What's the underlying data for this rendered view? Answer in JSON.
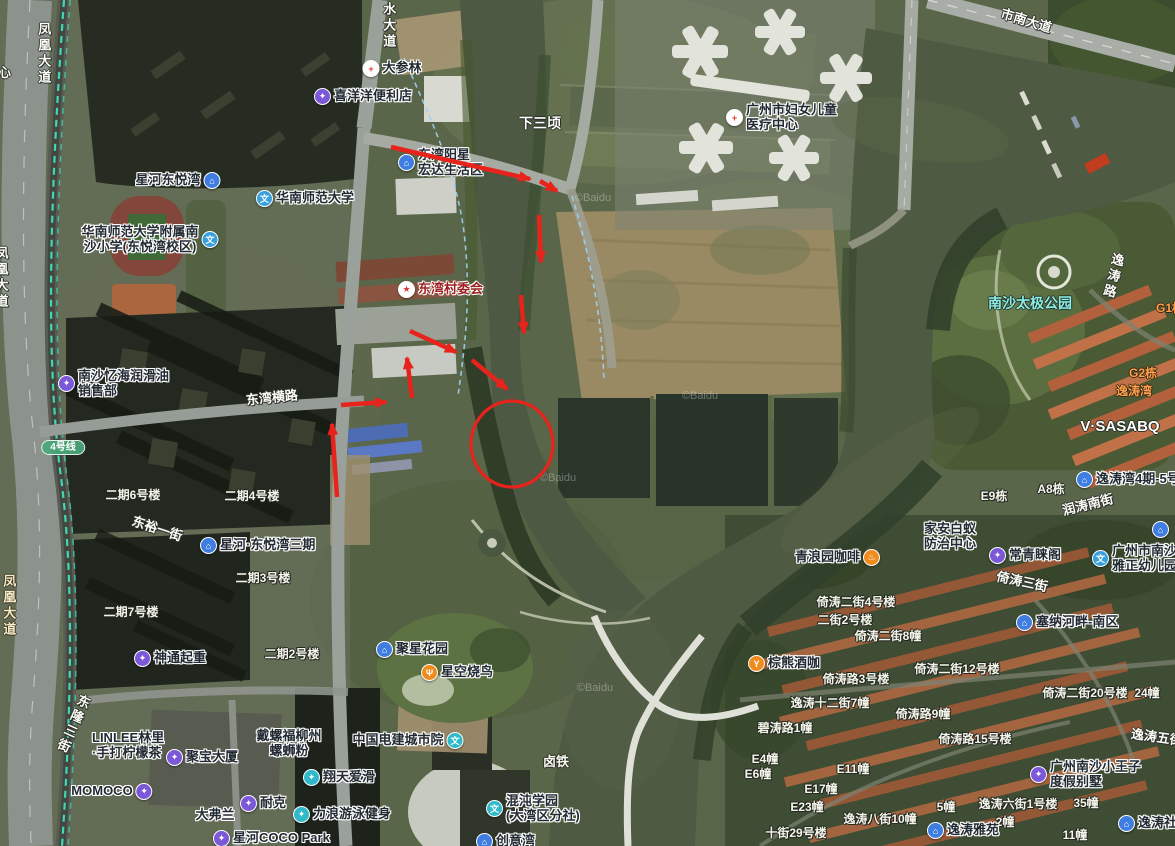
{
  "map": {
    "attribution": "©Baidu",
    "annotation_color": "#e8231c",
    "water_color": "#4f5a42",
    "metro_line_color": "#3fe0bc",
    "icons": {
      "building": {
        "glyph": "⌂",
        "bg": "#3f7de0"
      },
      "shop": {
        "glyph": "✦",
        "bg": "#7a58d8"
      },
      "school": {
        "glyph": "文",
        "bg": "#38a0dc"
      },
      "school_teal": {
        "glyph": "文",
        "bg": "#2fb9c9"
      },
      "hospital": {
        "glyph": "+",
        "bg": "#ffffff",
        "fg": "#e23b30"
      },
      "gov": {
        "glyph": "★",
        "bg": "#ffffff",
        "fg": "#d8383a"
      },
      "pharmacy": {
        "glyph": "+",
        "bg": "#ffffff",
        "fg": "#e23b30"
      },
      "coffee": {
        "glyph": "♨",
        "bg": "#f08c1e"
      },
      "bar": {
        "glyph": "Y",
        "bg": "#f08c1e"
      },
      "food": {
        "glyph": "Ψ",
        "bg": "#f08c1e"
      },
      "sport": {
        "glyph": "✦",
        "bg": "#2fb9c9"
      }
    },
    "labels": [
      {
        "text": "凤凰大道",
        "x": 43,
        "y": 22,
        "type": "road",
        "vertical": true
      },
      {
        "text": "心",
        "x": -2,
        "y": 66,
        "type": "area",
        "anchor": "left"
      },
      {
        "text": "凤凰大道",
        "x": -7,
        "y": 246,
        "type": "road",
        "vertical": true,
        "anchor": "left"
      },
      {
        "text": "凤凰大道",
        "x": 8,
        "y": 574,
        "type": "road_y",
        "vertical": true
      },
      {
        "text": "滨水大道",
        "x": 388,
        "y": -14,
        "type": "road",
        "vertical": true
      },
      {
        "text": "大参林",
        "x": 392,
        "y": 60,
        "type": "poi",
        "icon": "pharmacy"
      },
      {
        "text": "喜洋洋便利店",
        "x": 363,
        "y": 88,
        "type": "poi",
        "icon": "shop"
      },
      {
        "text": "下三顷",
        "x": 540,
        "y": 116,
        "type": "area_lg"
      },
      {
        "text": "市南大道",
        "x": 1026,
        "y": 14,
        "type": "road",
        "rot": 17
      },
      {
        "lines": [
          "广州市妇女儿童",
          "医疗中心"
        ],
        "x": 726,
        "y": 103,
        "type": "poi",
        "icon": "hospital",
        "anchor": "left",
        "align": "left"
      },
      {
        "text": "星河东悦湾",
        "x": 178,
        "y": 172,
        "type": "poi",
        "icon": "building",
        "icon_side": "right"
      },
      {
        "text": "华南师范大学",
        "x": 305,
        "y": 190,
        "type": "poi",
        "icon": "school"
      },
      {
        "lines": [
          "华南师范大学附属南",
          "沙小学(东悦湾校区)"
        ],
        "x": 150,
        "y": 225,
        "type": "poi",
        "icon": "school",
        "icon_side": "right"
      },
      {
        "lines": [
          "东湾阳星",
          "宏达生活区"
        ],
        "x": 398,
        "y": 148,
        "type": "poi",
        "icon": "building",
        "anchor": "left",
        "align": "left"
      },
      {
        "text": "东湾村委会",
        "x": 398,
        "y": 281,
        "type": "gov",
        "icon": "gov",
        "anchor": "left"
      },
      {
        "lines": [
          "南沙忆海润滑油",
          "销售部"
        ],
        "x": 58,
        "y": 369,
        "type": "poi",
        "icon": "shop",
        "anchor": "left",
        "align": "left"
      },
      {
        "text": "东湾横路",
        "x": 272,
        "y": 391,
        "type": "road",
        "rot": -6
      },
      {
        "text": "4号线",
        "x": 63,
        "y": 440,
        "type": "metro"
      },
      {
        "text": "二期6号楼",
        "x": 133,
        "y": 489,
        "type": "bldg"
      },
      {
        "text": "二期4号楼",
        "x": 252,
        "y": 490,
        "type": "bldg"
      },
      {
        "text": "东裕一街",
        "x": 157,
        "y": 522,
        "type": "road",
        "rot": 18
      },
      {
        "text": "星河·东悦湾三期",
        "x": 200,
        "y": 537,
        "type": "poi",
        "icon": "building",
        "anchor": "left"
      },
      {
        "text": "二期3号楼",
        "x": 263,
        "y": 572,
        "type": "bldg"
      },
      {
        "text": "二期7号楼",
        "x": 131,
        "y": 606,
        "type": "bldg"
      },
      {
        "text": "神通起重",
        "x": 134,
        "y": 650,
        "type": "poi",
        "icon": "shop",
        "anchor": "left"
      },
      {
        "text": "二期2号楼",
        "x": 292,
        "y": 648,
        "type": "bldg"
      },
      {
        "text": "东隆三街",
        "x": 72,
        "y": 692,
        "type": "road",
        "vertical": true,
        "rot": 24
      },
      {
        "lines": [
          "LINLEE林里",
          "·手打柠檬茶"
        ],
        "x": 92,
        "y": 731,
        "type": "poi_plain",
        "anchor": "left",
        "align": "left"
      },
      {
        "text": "聚宝大厦",
        "x": 166,
        "y": 749,
        "type": "poi",
        "icon": "shop",
        "anchor": "left"
      },
      {
        "text": "MOMOCO",
        "x": 112,
        "y": 783,
        "type": "poi",
        "icon": "shop",
        "icon_side": "right"
      },
      {
        "lines": [
          "戴螺福柳州",
          "螺蛳粉"
        ],
        "x": 289,
        "y": 729,
        "type": "poi_plain"
      },
      {
        "text": "翔天爱滑",
        "x": 303,
        "y": 769,
        "type": "poi",
        "icon": "sport",
        "anchor": "left"
      },
      {
        "text": "耐克",
        "x": 240,
        "y": 795,
        "type": "poi",
        "icon": "shop",
        "anchor": "left"
      },
      {
        "text": "大弗兰",
        "x": 215,
        "y": 808,
        "type": "poi_plain"
      },
      {
        "text": "力浪游泳健身",
        "x": 293,
        "y": 806,
        "type": "poi",
        "icon": "sport",
        "anchor": "left"
      },
      {
        "text": "星河COCO Park",
        "x": 213,
        "y": 830,
        "type": "poi",
        "icon": "shop",
        "anchor": "left"
      },
      {
        "text": "聚星花园",
        "x": 376,
        "y": 641,
        "type": "poi",
        "icon": "building",
        "anchor": "left"
      },
      {
        "text": "星空烧鸟",
        "x": 421,
        "y": 664,
        "type": "poi",
        "icon": "food",
        "anchor": "left"
      },
      {
        "text": "中国电建城市院",
        "x": 408,
        "y": 732,
        "type": "poi",
        "icon": "school_teal",
        "icon_side": "right"
      },
      {
        "text": "卤铁",
        "x": 556,
        "y": 755,
        "type": "area"
      },
      {
        "lines": [
          "混沌学园",
          "(大湾区分社)"
        ],
        "x": 486,
        "y": 794,
        "type": "poi",
        "icon": "school_teal",
        "anchor": "left",
        "align": "left"
      },
      {
        "text": "创意湾",
        "x": 476,
        "y": 833,
        "type": "poi",
        "icon": "building",
        "anchor": "left"
      },
      {
        "text": "南沙太极公园",
        "x": 1030,
        "y": 296,
        "type": "cyan"
      },
      {
        "text": "逸涛路",
        "x": 1112,
        "y": 252,
        "type": "road",
        "vertical": true,
        "rot": 14
      },
      {
        "text": "G1栋",
        "x": 1156,
        "y": 302,
        "type": "orange",
        "anchor": "left"
      },
      {
        "text": "G2栋",
        "x": 1143,
        "y": 367,
        "type": "orange"
      },
      {
        "text": "逸涛湾",
        "x": 1134,
        "y": 385,
        "type": "orange"
      },
      {
        "text": "V·SASABQ",
        "x": 1120,
        "y": 419,
        "type": "white_lg"
      },
      {
        "text": "E9栋",
        "x": 994,
        "y": 490,
        "type": "bldg"
      },
      {
        "text": "A8栋",
        "x": 1051,
        "y": 483,
        "type": "bldg"
      },
      {
        "text": "逸涛湾4期-5号门",
        "x": 1076,
        "y": 471,
        "type": "poi",
        "icon": "building",
        "anchor": "left"
      },
      {
        "text": "润涛南街",
        "x": 1088,
        "y": 498,
        "type": "road",
        "rot": -14
      },
      {
        "lines": [
          "家安白蚁",
          "防治中心"
        ],
        "x": 950,
        "y": 522,
        "type": "poi_plain"
      },
      {
        "text": "常青睐阁",
        "x": 989,
        "y": 547,
        "type": "poi",
        "icon": "shop",
        "anchor": "left"
      },
      {
        "lines": [
          "广州市南沙",
          "雅正幼儿园"
        ],
        "x": 1092,
        "y": 544,
        "type": "poi",
        "icon": "school",
        "anchor": "left",
        "align": "left"
      },
      {
        "text": "",
        "x": 1152,
        "y": 521,
        "type": "poi",
        "icon": "building",
        "anchor": "left"
      },
      {
        "text": "青浪园咖啡",
        "x": 795,
        "y": 549,
        "type": "poi",
        "icon": "coffee",
        "icon_side": "right",
        "anchor": "left"
      },
      {
        "text": "倚涛三街",
        "x": 1022,
        "y": 575,
        "type": "road",
        "rot": 12
      },
      {
        "text": "倚涛二街4号楼",
        "x": 856,
        "y": 596,
        "type": "bldg"
      },
      {
        "text": "二街2号楼",
        "x": 845,
        "y": 614,
        "type": "bldg"
      },
      {
        "text": "倚涛二街8幢",
        "x": 888,
        "y": 630,
        "type": "bldg"
      },
      {
        "text": "塞纳河畔-南区",
        "x": 1016,
        "y": 614,
        "type": "poi",
        "icon": "building",
        "anchor": "left"
      },
      {
        "text": "棕熊酒咖",
        "x": 748,
        "y": 655,
        "type": "poi",
        "icon": "bar",
        "anchor": "left"
      },
      {
        "text": "倚涛二街12号楼",
        "x": 957,
        "y": 663,
        "type": "bldg"
      },
      {
        "text": "倚涛路3号楼",
        "x": 856,
        "y": 673,
        "type": "bldg"
      },
      {
        "text": "逸涛十二街7幢",
        "x": 830,
        "y": 697,
        "type": "bldg"
      },
      {
        "text": "倚涛路9幢",
        "x": 923,
        "y": 708,
        "type": "bldg"
      },
      {
        "text": "碧涛路1幢",
        "x": 785,
        "y": 722,
        "type": "bldg"
      },
      {
        "text": "倚涛路15号楼",
        "x": 975,
        "y": 733,
        "type": "bldg"
      },
      {
        "text": "倚涛二街20号楼  24幢",
        "x": 1101,
        "y": 687,
        "type": "bldg"
      },
      {
        "text": "逸涛五街",
        "x": 1131,
        "y": 727,
        "type": "road",
        "rot": 8,
        "anchor": "left"
      },
      {
        "text": "E4幢",
        "x": 765,
        "y": 753,
        "type": "bldg"
      },
      {
        "text": "E6幢",
        "x": 758,
        "y": 768,
        "type": "bldg"
      },
      {
        "text": "E11幢",
        "x": 853,
        "y": 763,
        "type": "bldg"
      },
      {
        "text": "E17幢",
        "x": 821,
        "y": 783,
        "type": "bldg"
      },
      {
        "text": "E23幢",
        "x": 807,
        "y": 801,
        "type": "bldg"
      },
      {
        "text": "逸涛八街10幢",
        "x": 880,
        "y": 813,
        "type": "bldg"
      },
      {
        "text": "5幢",
        "x": 946,
        "y": 801,
        "type": "bldg"
      },
      {
        "text": "逸涛六街1号楼",
        "x": 1018,
        "y": 798,
        "type": "bldg"
      },
      {
        "text": "2幢",
        "x": 1005,
        "y": 816,
        "type": "bldg"
      },
      {
        "text": "35幢",
        "x": 1086,
        "y": 797,
        "type": "bldg"
      },
      {
        "text": "逸涛雅苑",
        "x": 927,
        "y": 822,
        "type": "poi",
        "icon": "building",
        "anchor": "left"
      },
      {
        "text": "十街29号楼",
        "x": 796,
        "y": 827,
        "type": "bldg"
      },
      {
        "text": "11幢",
        "x": 1075,
        "y": 829,
        "type": "bldg"
      },
      {
        "lines": [
          "广州南沙小王子",
          "度假别墅"
        ],
        "x": 1030,
        "y": 760,
        "type": "poi",
        "icon": "shop",
        "anchor": "left",
        "align": "left"
      },
      {
        "text": "逸涛社区",
        "x": 1118,
        "y": 815,
        "type": "poi",
        "icon": "building",
        "anchor": "left"
      },
      {
        "text": "©Baidu",
        "x": 593,
        "y": 192,
        "type": "wm"
      },
      {
        "text": "©Baidu",
        "x": 700,
        "y": 390,
        "type": "wm"
      },
      {
        "text": "©Baidu",
        "x": 558,
        "y": 472,
        "type": "wm"
      },
      {
        "text": "©Baidu",
        "x": 595,
        "y": 682,
        "type": "wm"
      }
    ],
    "annotations": {
      "arrows": [
        {
          "x1": 391,
          "y1": 147,
          "x2": 530,
          "y2": 179
        },
        {
          "x1": 540,
          "y1": 181,
          "x2": 557,
          "y2": 191
        },
        {
          "x1": 539,
          "y1": 215,
          "x2": 541,
          "y2": 262
        },
        {
          "x1": 521,
          "y1": 295,
          "x2": 524,
          "y2": 333
        },
        {
          "x1": 410,
          "y1": 331,
          "x2": 456,
          "y2": 352
        },
        {
          "x1": 472,
          "y1": 360,
          "x2": 507,
          "y2": 389
        },
        {
          "x1": 412,
          "y1": 398,
          "x2": 407,
          "y2": 358
        },
        {
          "x1": 341,
          "y1": 405,
          "x2": 386,
          "y2": 402
        },
        {
          "x1": 337,
          "y1": 497,
          "x2": 332,
          "y2": 424
        }
      ],
      "circle": {
        "cx": 512,
        "cy": 444,
        "rx": 41,
        "ry": 43
      }
    }
  }
}
